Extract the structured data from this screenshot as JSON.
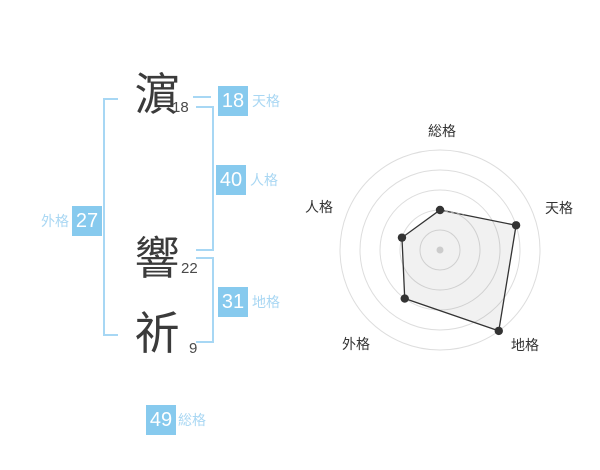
{
  "colors": {
    "accent": "#87CAEE",
    "accent_light": "#A9D7F3",
    "bracket": "#A7D7F4",
    "kanji_text": "#3b3b3b",
    "chart_ring": "#dddddd",
    "chart_line": "#333333",
    "chart_fill": "rgba(0,0,0,0.055)",
    "chart_dot": "#333333",
    "chart_center_dot": "#cccccc"
  },
  "name": {
    "characters": [
      {
        "char": "濵",
        "strokes": "18"
      },
      {
        "char": "響",
        "strokes": "22"
      },
      {
        "char": "祈",
        "strokes": "9"
      }
    ]
  },
  "categories": [
    {
      "id": "tenkaku",
      "label": "天格",
      "value": "18"
    },
    {
      "id": "jinkaku",
      "label": "人格",
      "value": "40"
    },
    {
      "id": "chikaku",
      "label": "地格",
      "value": "31"
    },
    {
      "id": "gaikaku",
      "label": "外格",
      "value": "27"
    },
    {
      "id": "soukaku",
      "label": "総格",
      "value": "49"
    }
  ],
  "chart_data": {
    "type": "radar",
    "axes": [
      "総格",
      "天格",
      "地格",
      "外格",
      "人格"
    ],
    "values": [
      2,
      4,
      5,
      3,
      2
    ],
    "scale_max": 5,
    "rings": 5,
    "grid": "concentric-circles",
    "legend": "none",
    "axes_order": "clockwise-from-top"
  }
}
